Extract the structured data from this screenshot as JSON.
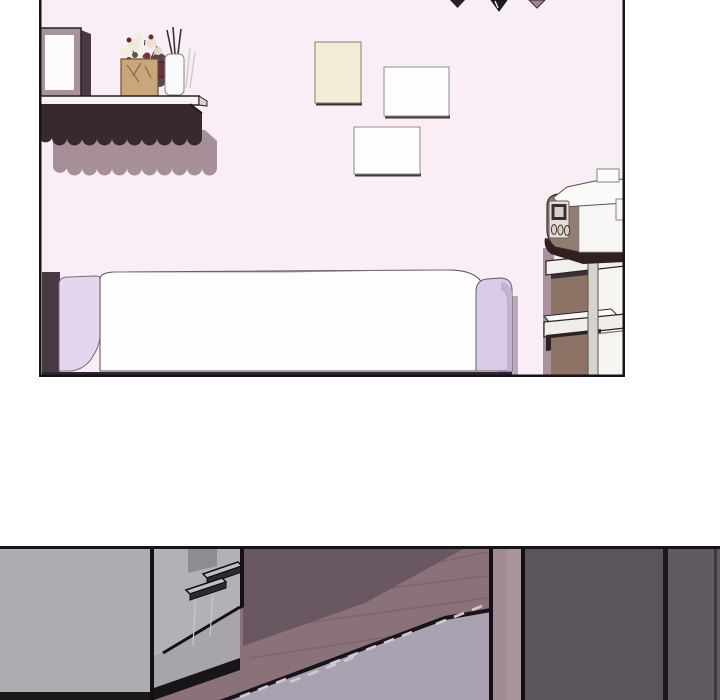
{
  "page": {
    "kind": "webtoon-comic-page",
    "background": "#ffffff",
    "panel_count": "2"
  },
  "colors": {
    "ink": "#131114",
    "panel_border": "#18131a",
    "wall": "#f9eef5",
    "valance_dark": "#38292f",
    "valance_shadow": "#a78f99",
    "shelf_board": "#f5f3f4",
    "frame_taupe": "#a6939b",
    "frame_inner": "#fdfbfc",
    "frame_shadow": "#4b3a44",
    "vase_tan": "#c9a77a",
    "foliage_dark": "#5d4454",
    "flower_light": "#f3efdf",
    "flower_red": "#7c3034",
    "diffuser_white": "#fbfafa",
    "cream_frame": "#f1edd8",
    "white_frame": "#fdfdfc",
    "frame_edge_dark": "#3a332c",
    "flag_dark": "#2b2028",
    "flag_black": "#201a24",
    "flag_pink": "#a8818d",
    "bed_white": "#fefdfd",
    "pillow_lavender": "#e5d6f0",
    "bed_band_lavender": "#d8cce6",
    "bed_gap_dark": "#473a43",
    "bed_wall_shadow": "#b9a9bb",
    "device_body": "#927d74",
    "device_white": "#f8f6f4",
    "device_panel": "#e5ddd7",
    "device_screen": "#3a2e2e",
    "cart_rail": "#f2f0ec",
    "cart_post": "#d6d4cb",
    "cart_bin": "#8d7365",
    "cart_dark": "#2c2226",
    "cart_side_shadow": "#a9929b",
    "floor": "#8b7179",
    "floor_shadow": "#695761",
    "wood_line": "#796069",
    "rug": "#aaa2b0",
    "rug_stitch": "#cfc9d4",
    "counter_gray": "#aeadb1",
    "cabinet_face": "#b3b1b5",
    "cabinet_face_lower": "#a7a5a9",
    "cabinet_patch": "#8e8c91",
    "handle_light": "#c2c0c4",
    "handle_dark": "#2e2b30",
    "door_post": "#a08c91",
    "wardrobe_left": "#5a545b",
    "wardrobe_right": "#5f5960"
  },
  "panels": [
    {
      "id": "panel-1",
      "label": "bedroom scene",
      "objects": [
        "bunting-flags",
        "photo-frame",
        "flower-box",
        "reed-diffuser",
        "wall-shelf",
        "scalloped-valance",
        "wall-frames",
        "bed",
        "humidifier",
        "utility-cart"
      ]
    },
    {
      "id": "panel-2",
      "label": "room corner scene",
      "objects": [
        "gray-counter",
        "cabinet-door",
        "cabinet-handles",
        "wood-floor",
        "floor-shadow",
        "stitched-rug",
        "door-post",
        "dark-wardrobe"
      ]
    }
  ]
}
